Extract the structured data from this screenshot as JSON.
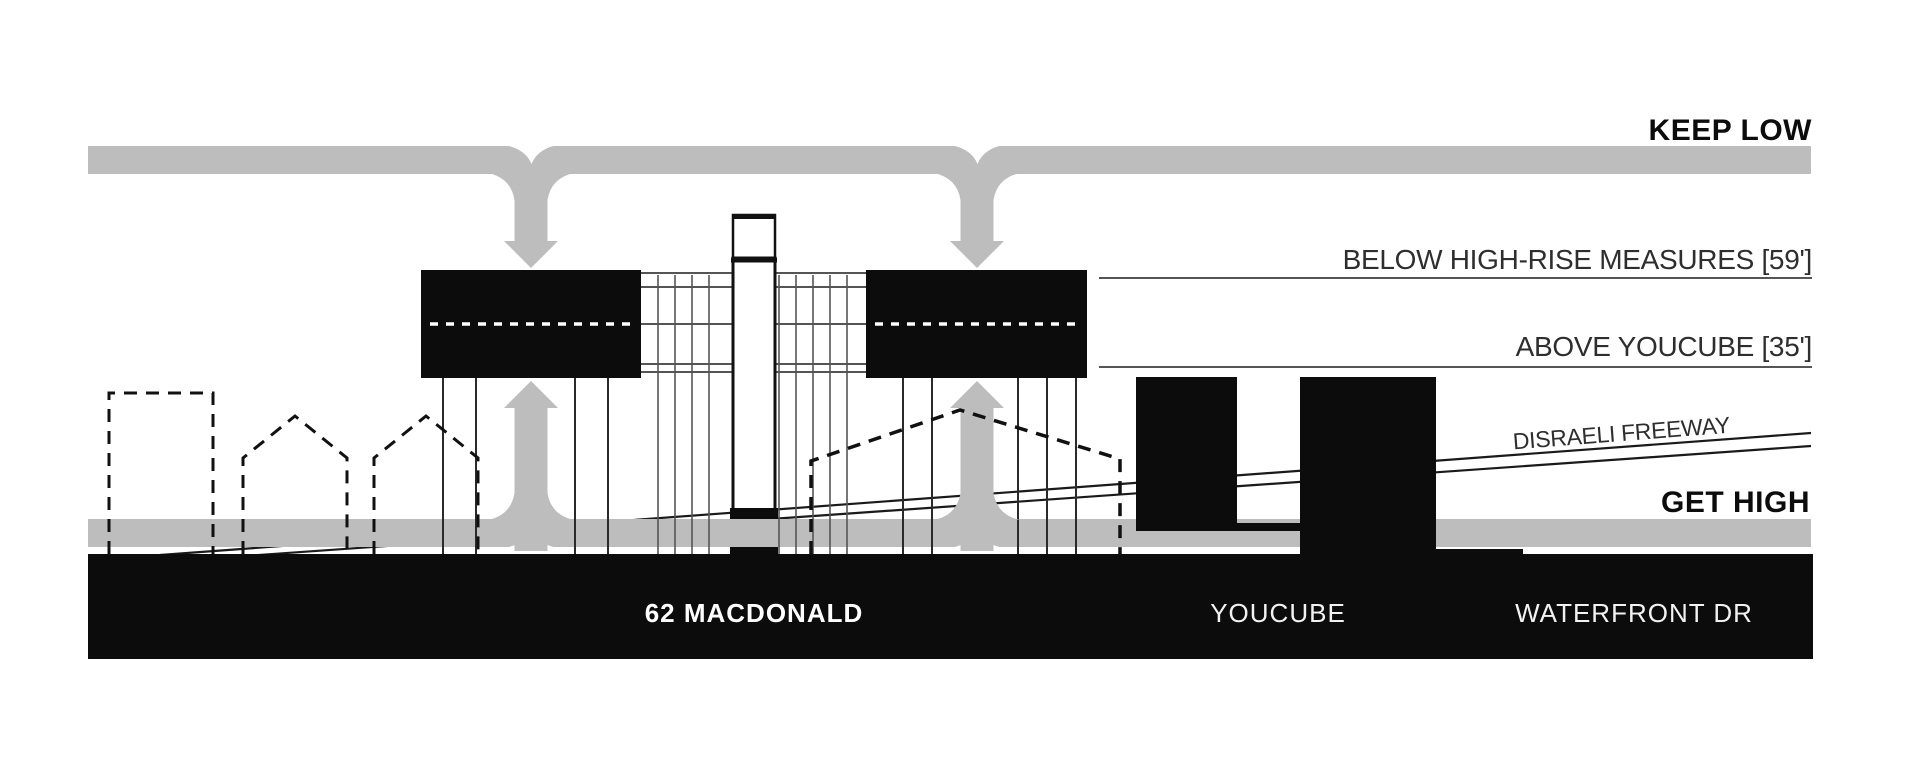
{
  "title": "Building massing height strategy section diagram",
  "colors": {
    "band_gray": "#bdbdbd",
    "black": "#0c0c0c",
    "white": "#ffffff",
    "line_gray": "#555555",
    "freeway_line": "#1a1a1a",
    "label_dark": "#2e2e2e",
    "ground_text": "#f2f2f2"
  },
  "annotations": {
    "keep_low": "KEEP LOW",
    "get_high": "GET HIGH",
    "below_high_rise": "BELOW HIGH-RISE MEASURES [59']",
    "above_youcube": "ABOVE YOUCUBE [35']",
    "disraeli_freeway": "DISRAELI FREEWAY"
  },
  "ground_labels": {
    "site": "62 MACDONALD",
    "youcube": "YOUCUBE",
    "waterfront": "WATERFRONT DR"
  }
}
